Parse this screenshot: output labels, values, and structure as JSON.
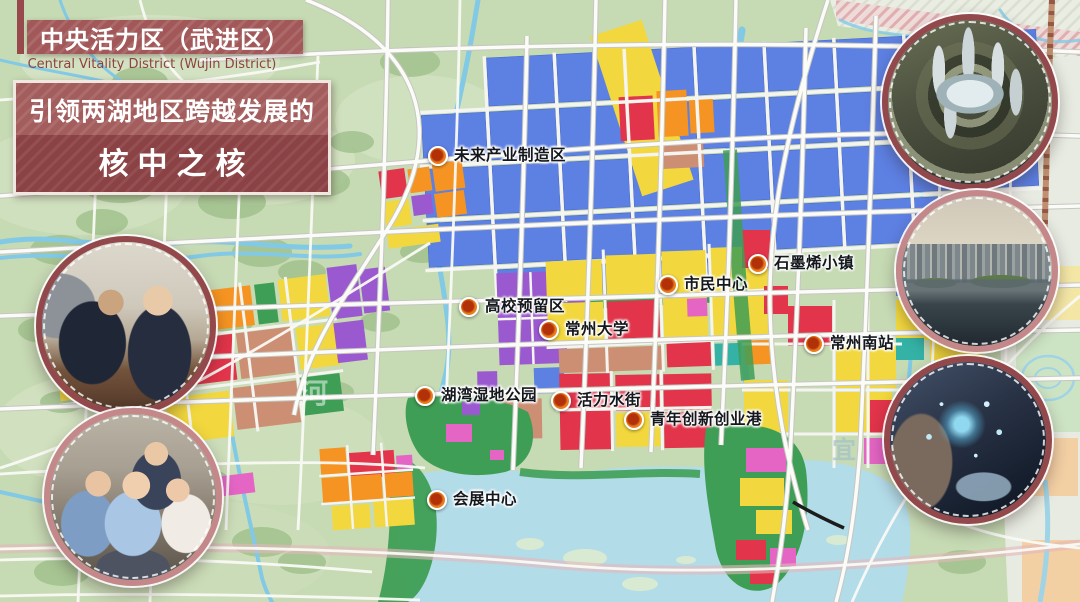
{
  "header": {
    "title": "中央活力区（武进区）",
    "subtitle_en": "Central Vitality District (Wujin District)"
  },
  "slogan": {
    "line1": "引领两湖地区跨越发展的",
    "line2": "核中之核"
  },
  "map": {
    "markers": [
      {
        "label": "未来产业制造区",
        "x": 437,
        "y": 156
      },
      {
        "label": "高校预留区",
        "x": 468,
        "y": 307
      },
      {
        "label": "常州大学",
        "x": 548,
        "y": 330
      },
      {
        "label": "市民中心",
        "x": 667,
        "y": 285
      },
      {
        "label": "石墨烯小镇",
        "x": 757,
        "y": 264
      },
      {
        "label": "常州南站",
        "x": 813,
        "y": 344
      },
      {
        "label": "湖湾湿地公园",
        "x": 424,
        "y": 396
      },
      {
        "label": "活力水街",
        "x": 560,
        "y": 401
      },
      {
        "label": "青年创新创业港",
        "x": 633,
        "y": 420
      },
      {
        "label": "会展中心",
        "x": 436,
        "y": 500
      }
    ],
    "watermarks": [
      {
        "text": "河"
      },
      {
        "text": "宜"
      }
    ],
    "legend_colors": {
      "industrial_blue": "#5d80e3",
      "residential_yellow": "#f2d83e",
      "commercial_red": "#e2344a",
      "mixed_orange": "#f59422",
      "campus_purple": "#9b59d0",
      "accent_magenta": "#e565c5",
      "salmon_brown": "#cd8f74",
      "park_green": "#3f9e55",
      "water_blue": "#82c9e6",
      "lake_blue": "#b3dce9",
      "title_maroon": "#8b4244",
      "marker_orange": "#e87d1e"
    }
  },
  "photo_insets": [
    {
      "name": "business-meeting-photo"
    },
    {
      "name": "team-celebration-photo"
    },
    {
      "name": "circular-complex-aerial-photo"
    },
    {
      "name": "lakefront-skyline-photo"
    },
    {
      "name": "smart-tech-hands-photo"
    }
  ]
}
